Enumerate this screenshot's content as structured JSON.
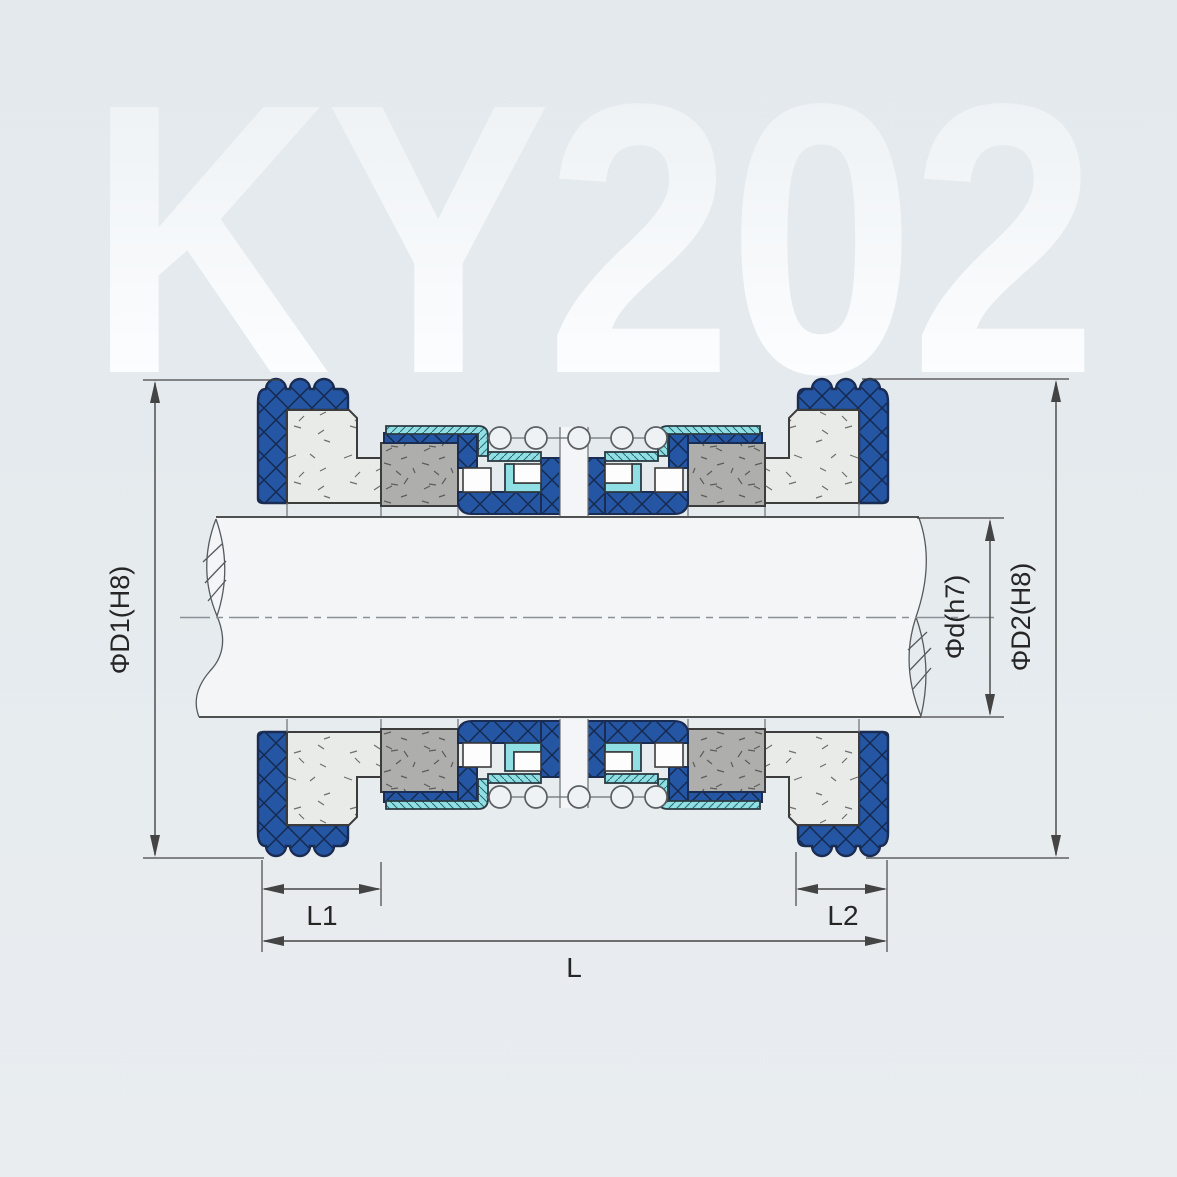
{
  "watermark": "KY202",
  "dimensions": {
    "d1_label": "ΦD1(H8)",
    "d_label": "Φd(h7)",
    "d2_label": "ΦD2(H8)",
    "l1_label": "L1",
    "l2_label": "L2",
    "l_label": "L"
  },
  "colors": {
    "bg_top": "#e3e9ed",
    "bg_bottom": "#e9edf0",
    "wm_top": "#eef2f5",
    "wm_bottom": "#fcfdfe",
    "rubber_blue": "#2456a4",
    "rubber_outline": "#1b2c52",
    "hatch_navy": "#16294f",
    "metal_cyan": "#8fdfe4",
    "cyan_hatch": "#2f6b73",
    "carbon_gray": "#aeaeac",
    "ceramic_white": "#e9ebe8",
    "speck": "#5c5c5c",
    "shaft_fill": "#f3f5f6",
    "line_dark": "#3a3a3a",
    "dim_line": "#444444",
    "centerline": "#8a9096",
    "label": "#262626"
  }
}
